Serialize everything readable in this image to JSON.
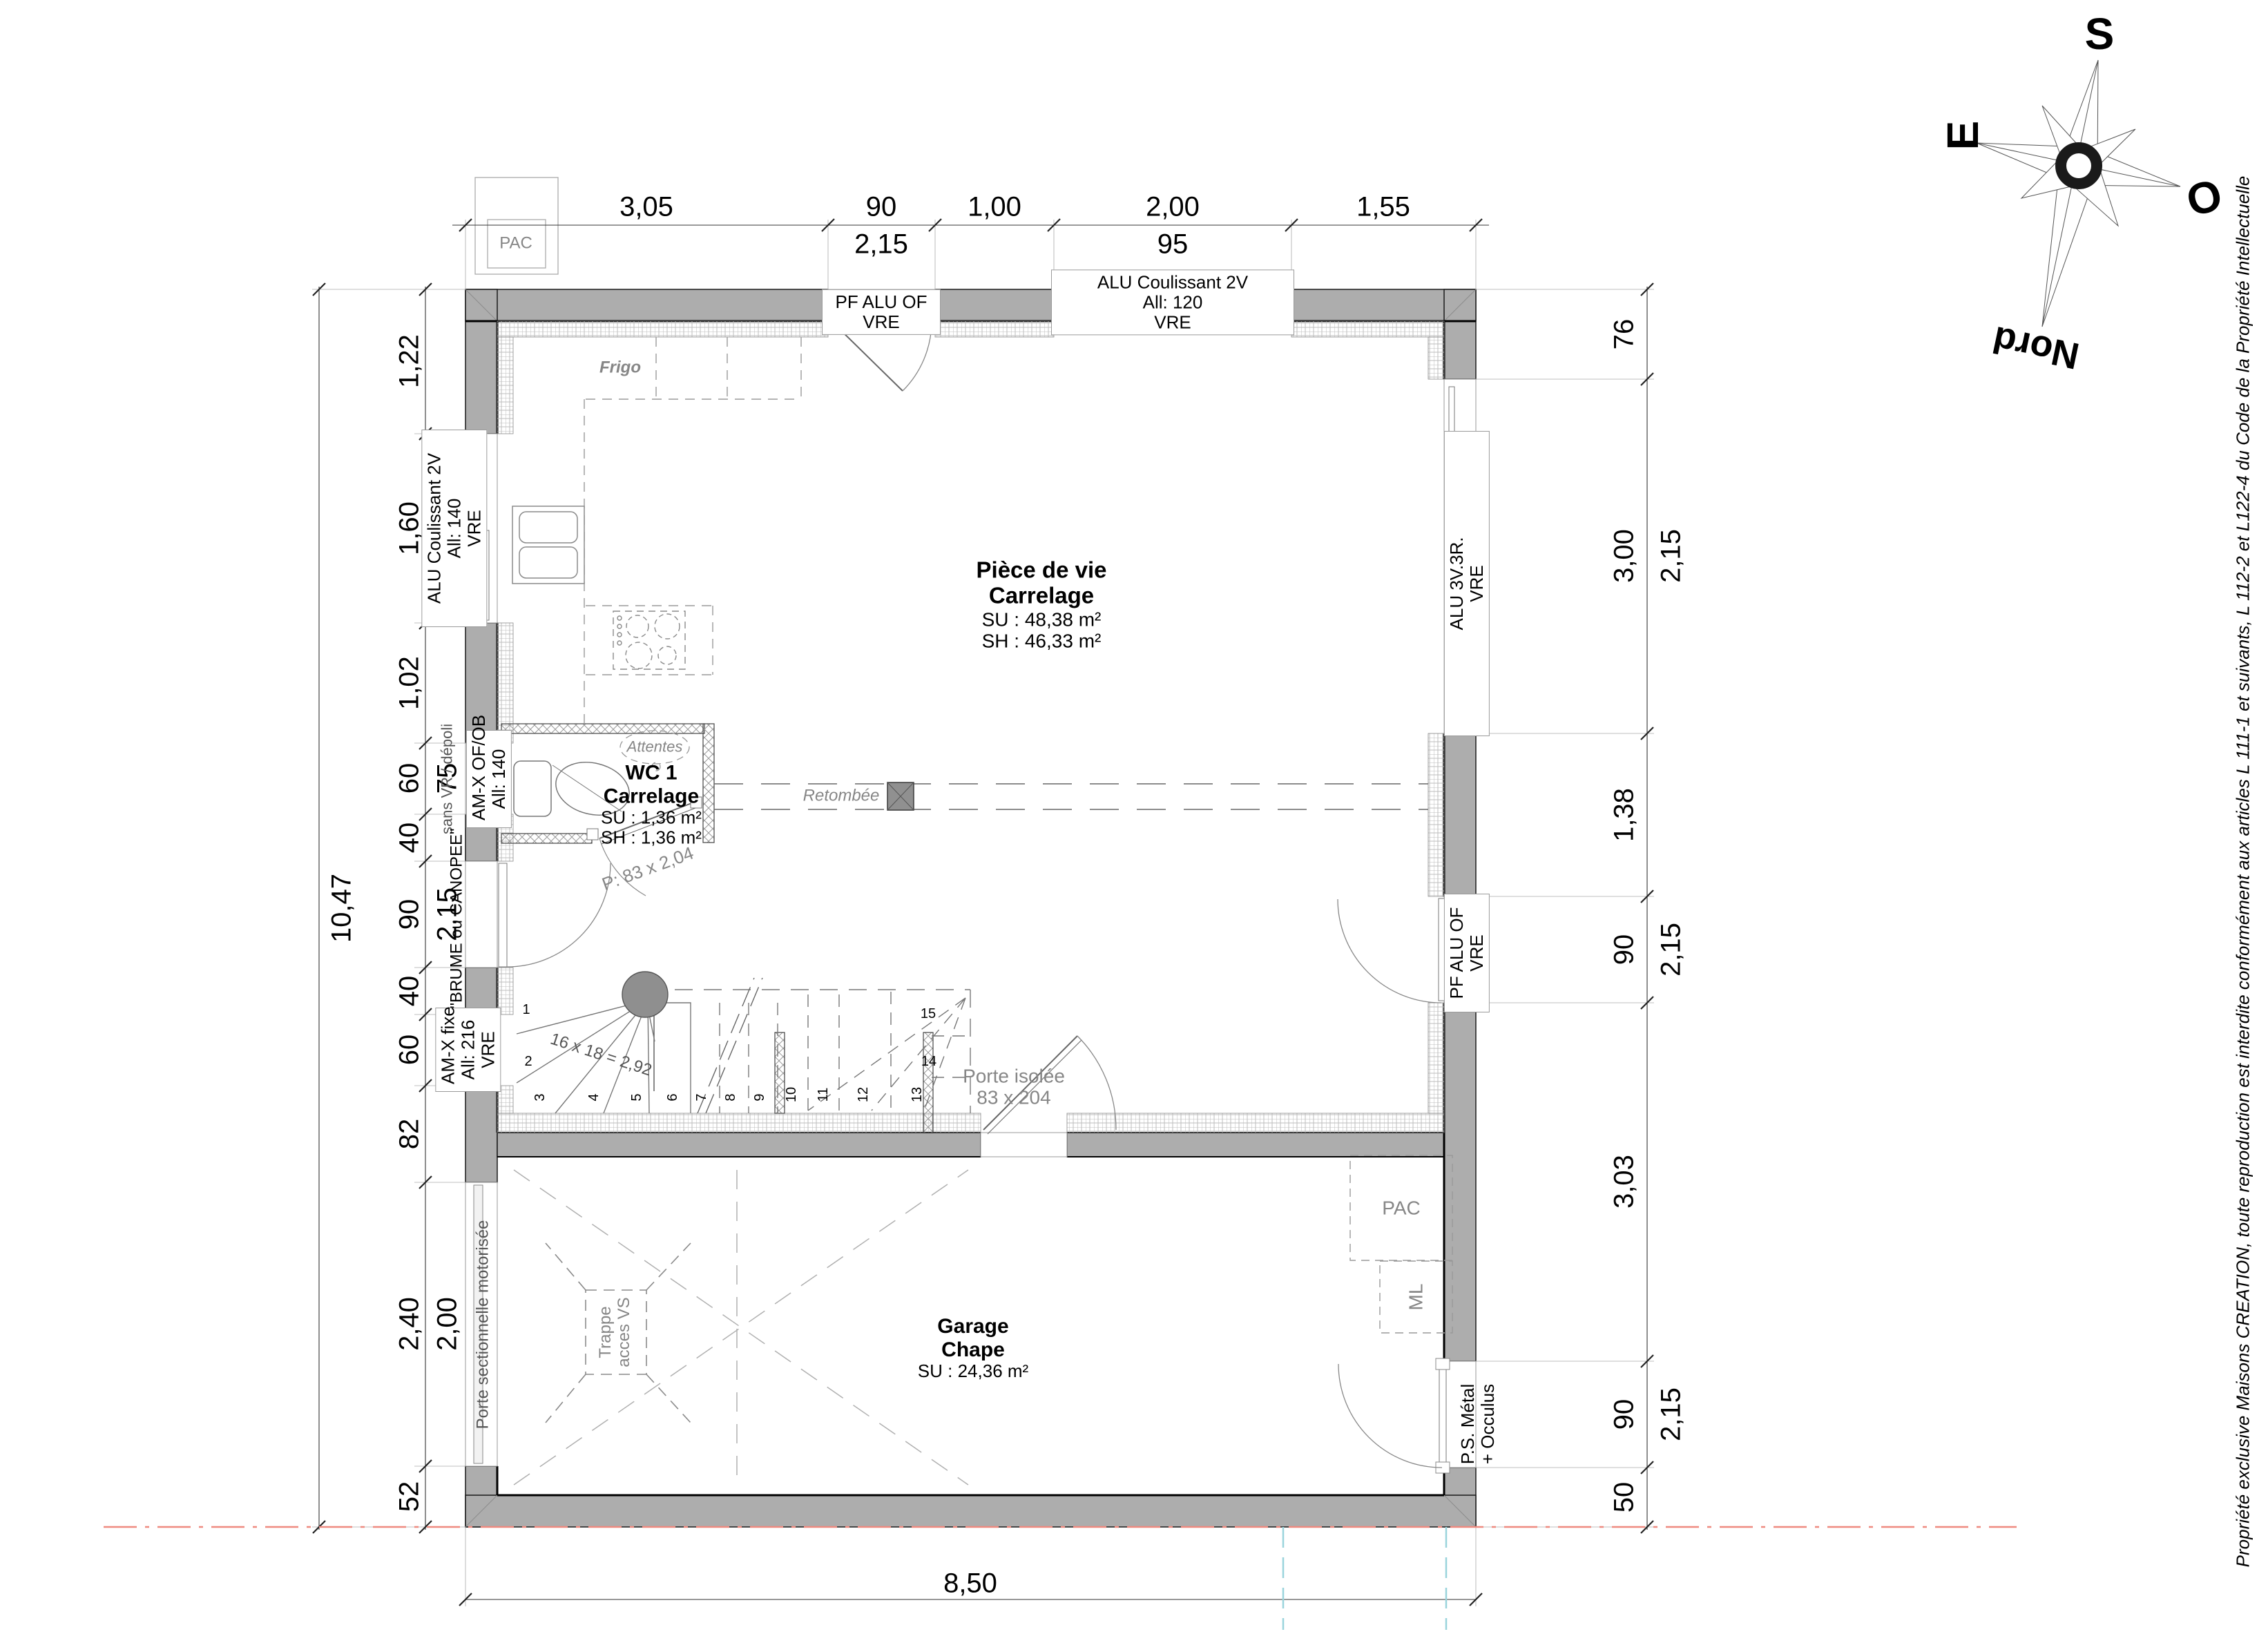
{
  "compass": {
    "s": "S",
    "e": "E",
    "o": "O",
    "nord": "Nord"
  },
  "copyright": "Propriété exclusive Maisons CREATION, toute reproduction est interdite conformément aux articles L 111-1 et suivants, L 112-2 et L122-4 du Code de la Propriété Intellectuelle",
  "rooms": {
    "living": {
      "title": "Pièce de vie",
      "floor": "Carrelage",
      "su": "SU : 48,38 m²",
      "sh": "SH : 46,33 m²"
    },
    "wc": {
      "title": "WC 1",
      "floor": "Carrelage",
      "su": "SU : 1,36 m²",
      "sh": "SH : 1,36 m²"
    },
    "garage": {
      "title": "Garage",
      "floor": "Chape",
      "su": "SU : 24,36 m²"
    }
  },
  "fixtures": {
    "frigo": "Frigo",
    "attentes": "Attentes",
    "retombee": "Retombée",
    "pac_ext": "PAC",
    "pac_garage": "PAC",
    "ml": "ML",
    "trappe": [
      "Trappe",
      "acces VS"
    ]
  },
  "openings": {
    "top_door": [
      "PF ALU OF",
      "VRE"
    ],
    "top_slider": [
      "ALU Coulissant 2V",
      "All: 120",
      "VRE"
    ],
    "left_slider": [
      "ALU Coulissant 2V",
      "All: 140",
      "VRE"
    ],
    "wc_window": [
      "AM-X OF/OB",
      "All: 140"
    ],
    "wc_window_note": "sans VR / dépoli",
    "wc_door": "P: 83 x 2,04",
    "entry_door": "\"BRUME ou CANOPEE\"",
    "left_fixed": [
      "AM-X fixe",
      "All: 216",
      "VRE"
    ],
    "garage_sectional": "Porte sectionnelle motorisée",
    "right_window": [
      "ALU 3V.3R.",
      "VRE"
    ],
    "right_door": [
      "PF ALU OF",
      "VRE"
    ],
    "garage_service_door": [
      "P.S. Métal",
      "+ Occulus"
    ],
    "interior_door": [
      "Porte isolée",
      "83 x 204"
    ]
  },
  "stairs": {
    "formula": "16 x 18 = 2,92",
    "steps": [
      "1",
      "2",
      "3",
      "4",
      "5",
      "6",
      "7",
      "8",
      "9",
      "10",
      "11",
      "12",
      "13",
      "14",
      "15"
    ]
  },
  "dims": {
    "overall_left": "10,47",
    "overall_bottom": "8,50",
    "top": [
      {
        "main": "3,05",
        "sub": ""
      },
      {
        "main": "90",
        "sub": "2,15"
      },
      {
        "main": "1,00",
        "sub": ""
      },
      {
        "main": "2,00",
        "sub": "95"
      },
      {
        "main": "1,55",
        "sub": ""
      }
    ],
    "left": [
      {
        "main": "1,22",
        "sub": ""
      },
      {
        "main": "1,60",
        "sub": "75"
      },
      {
        "main": "1,02",
        "sub": ""
      },
      {
        "main": "60",
        "sub": "75"
      },
      {
        "main": "40",
        "sub": ""
      },
      {
        "main": "90",
        "sub": "2,15"
      },
      {
        "main": "40",
        "sub": ""
      },
      {
        "main": "60",
        "sub": "1,85"
      },
      {
        "main": "82",
        "sub": ""
      },
      {
        "main": "2,40",
        "sub": "2,00"
      },
      {
        "main": "52",
        "sub": ""
      }
    ],
    "right": [
      {
        "main": "76",
        "sub": ""
      },
      {
        "main": "3,00",
        "sub": "2,15"
      },
      {
        "main": "1,38",
        "sub": ""
      },
      {
        "main": "90",
        "sub": "2,15"
      },
      {
        "main": "3,03",
        "sub": ""
      },
      {
        "main": "90",
        "sub": "2,15"
      },
      {
        "main": "50",
        "sub": ""
      }
    ]
  }
}
